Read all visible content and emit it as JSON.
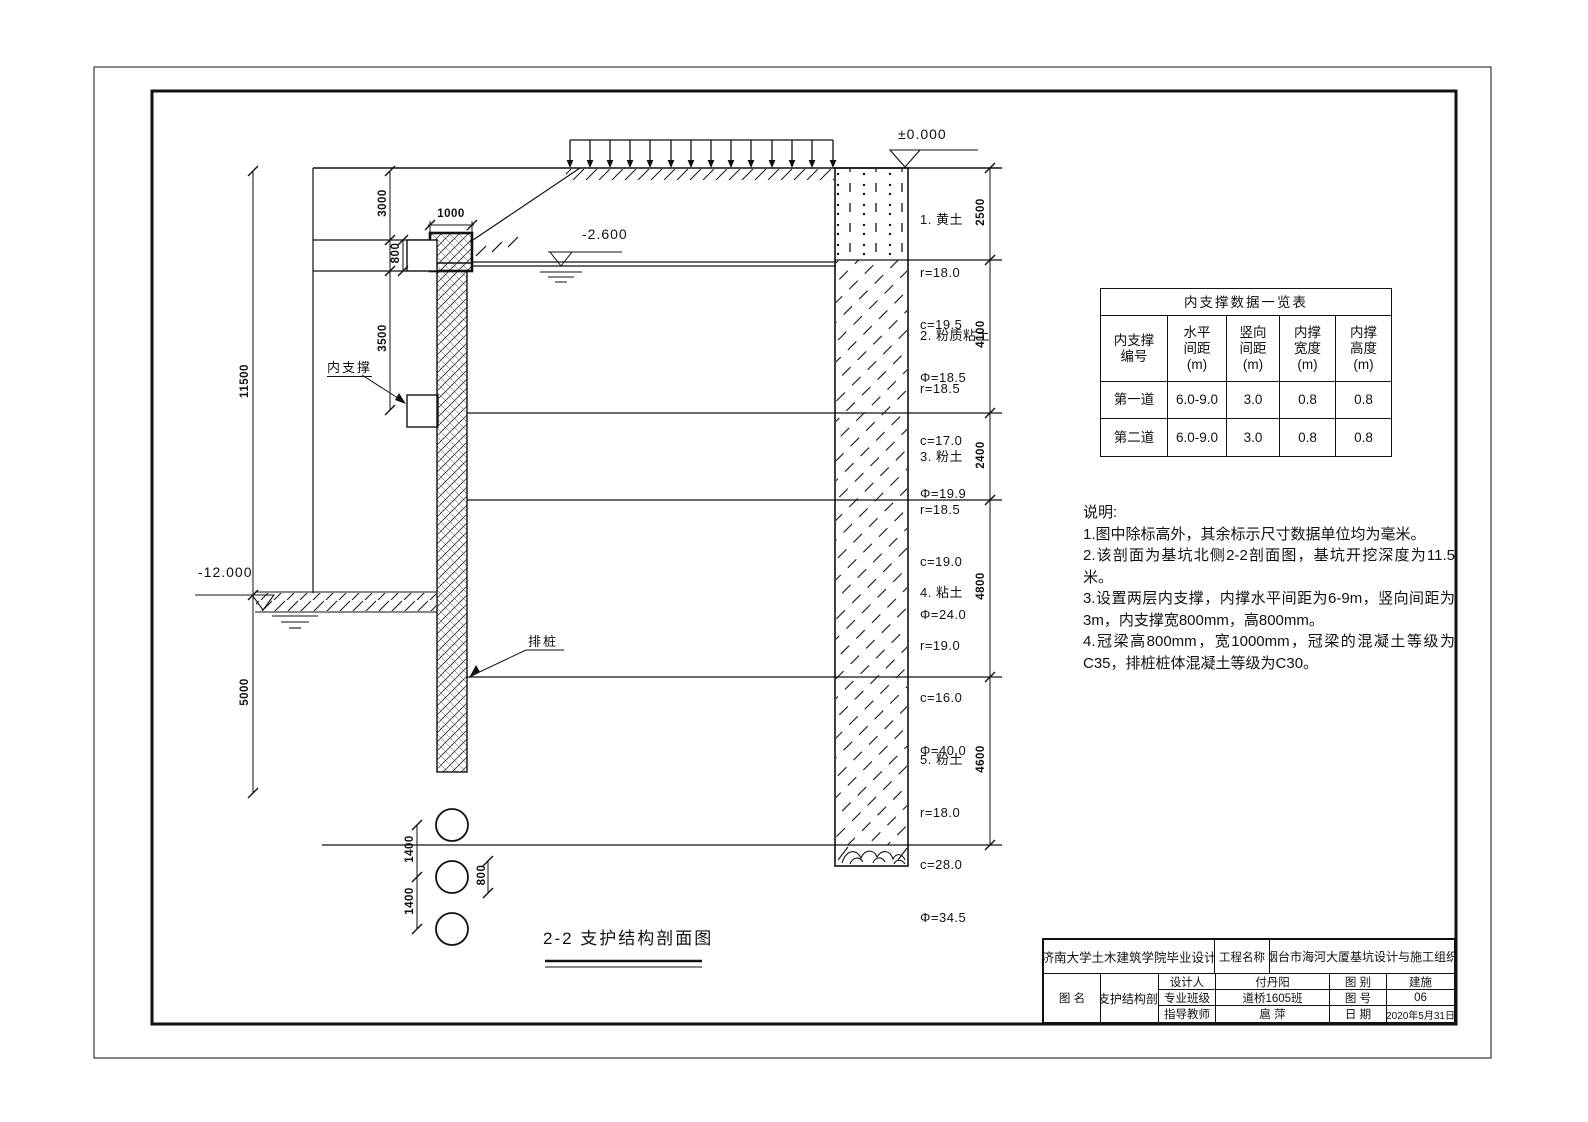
{
  "drawing": {
    "caption": "2-2 支护结构剖面图",
    "elevation_zero": "±0.000",
    "water_level": "-2.600",
    "pit_bottom_level": "-12.000",
    "inner_support_label": "内支撑",
    "pile_label": "排桩",
    "soil_layers": [
      {
        "name": "1. 黄土",
        "r": "r=18.0",
        "c": "c=19.5",
        "phi": "Φ=18.5"
      },
      {
        "name": "2. 粉质粘土",
        "r": "r=18.5",
        "c": "c=17.0",
        "phi": "Φ=19.9"
      },
      {
        "name": "3. 粉土",
        "r": "r=18.5",
        "c": "c=19.0",
        "phi": "Φ=24.0"
      },
      {
        "name": "4. 粘土",
        "r": "r=19.0",
        "c": "c=16.0",
        "phi": "Φ=40.0"
      },
      {
        "name": "5. 粉土",
        "r": "r=18.0",
        "c": "c=28.0",
        "phi": "Φ=34.5"
      }
    ],
    "dims": {
      "right": [
        "2500",
        "4100",
        "2400",
        "4800",
        "4600"
      ],
      "left_total": "11500",
      "left_below": "5000",
      "top_offset": "3000",
      "crown_height": "800",
      "support_spacing": "3500",
      "crown_width": "1000",
      "pile_spacing_1": "1400",
      "pile_spacing_2": "1400",
      "pile_diameter": "800"
    }
  },
  "support_table": {
    "title": "内支撑数据一览表",
    "headers": [
      "内支撑\n编号",
      "水平\n间距\n(m)",
      "竖向\n间距\n(m)",
      "内撑\n宽度\n(m)",
      "内撑\n高度\n(m)"
    ],
    "rows": [
      [
        "第一道",
        "6.0-9.0",
        "3.0",
        "0.8",
        "0.8"
      ],
      [
        "第二道",
        "6.0-9.0",
        "3.0",
        "0.8",
        "0.8"
      ]
    ]
  },
  "notes": {
    "heading": "说明:",
    "items": [
      "1.图中除标高外，其余标示尺寸数据单位均为毫米。",
      "2.该剖面为基坑北侧2-2剖面图，基坑开挖深度为11.5米。",
      "3.设置两层内支撑，内撑水平间距为6-9m，竖向间距为3m，内支撑宽800mm，高800mm。",
      "4.冠梁高800mm，宽1000mm，冠梁的混凝土等级为C35，排桩桩体混凝土等级为C30。"
    ]
  },
  "title_block": {
    "university": "济南大学土木建筑学院毕业设计",
    "project_label": "工程名称",
    "project_name": "烟台市海河大厦基坑设计与施工组织",
    "designer_label": "设计人",
    "designer": "付丹阳",
    "class_label": "专业班级",
    "class_name": "道桥1605班",
    "advisor_label": "指导教师",
    "advisor": "扈 萍",
    "drawing_name_label": "图 名",
    "drawing_name": "2-2 支护结构剖面图",
    "category_label": "图 别",
    "category": "建施",
    "sheet_no_label": "图 号",
    "sheet_no": "06",
    "date_label": "日 期",
    "date": "2020年5月31日"
  }
}
